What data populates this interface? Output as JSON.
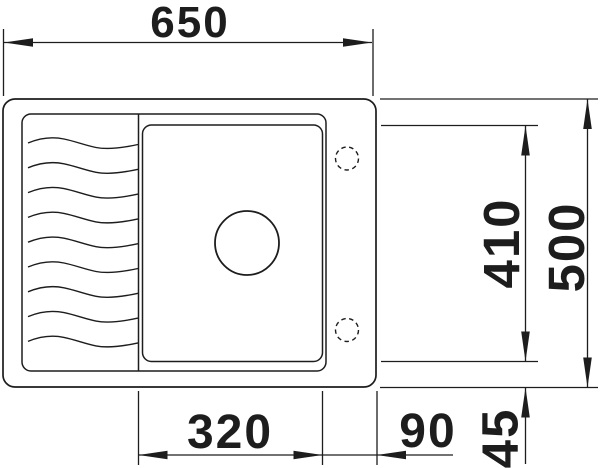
{
  "dimensions": {
    "overall_width": "650",
    "overall_depth": "500",
    "bowl_depth": "410",
    "bowl_width": "320",
    "right_offset": "90",
    "bottom_offset": "45"
  },
  "colors": {
    "line": "#1d1d1d",
    "background": "#ffffff"
  }
}
